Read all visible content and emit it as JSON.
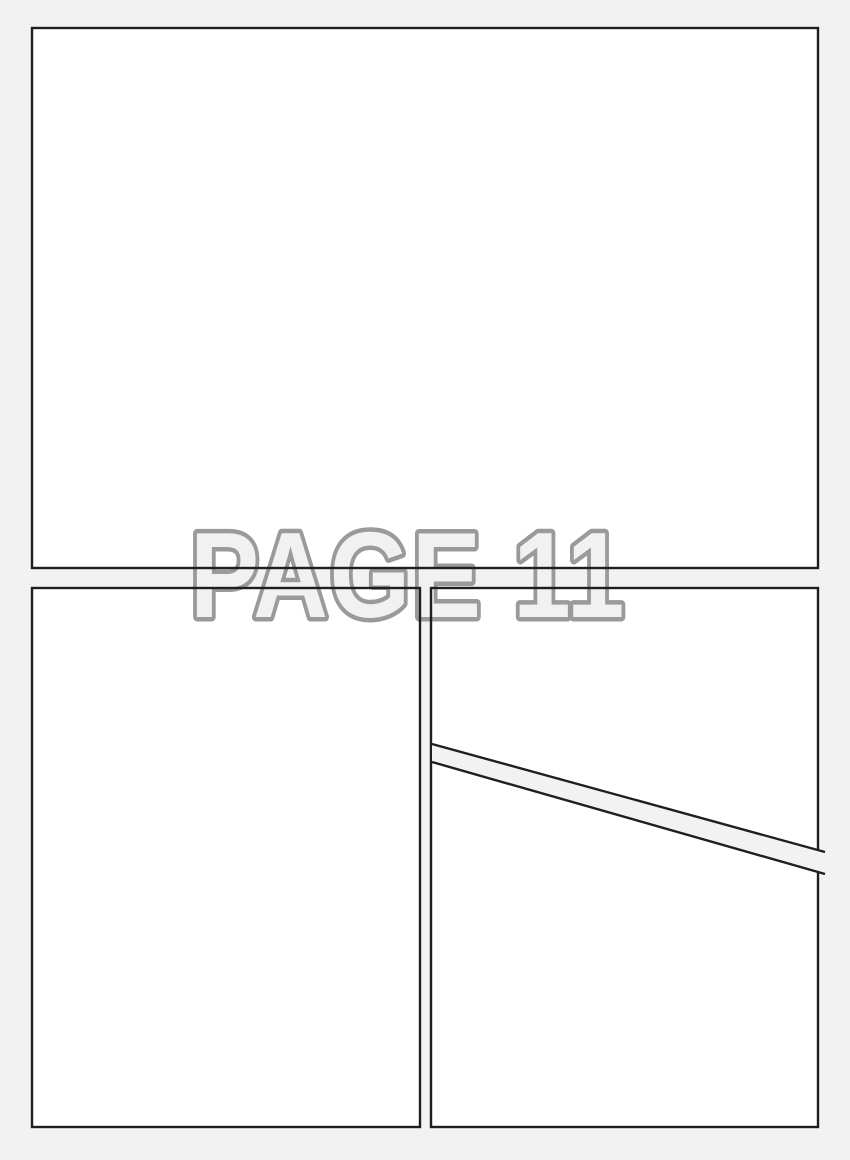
{
  "page": {
    "label": "PAGE 11"
  },
  "colors": {
    "background": "#f2f2f2",
    "panel_fill": "#ffffff",
    "panel_border": "#1f1f1f",
    "label_outline": "#9a9a9a",
    "label_fill": "#f1f1f1"
  }
}
